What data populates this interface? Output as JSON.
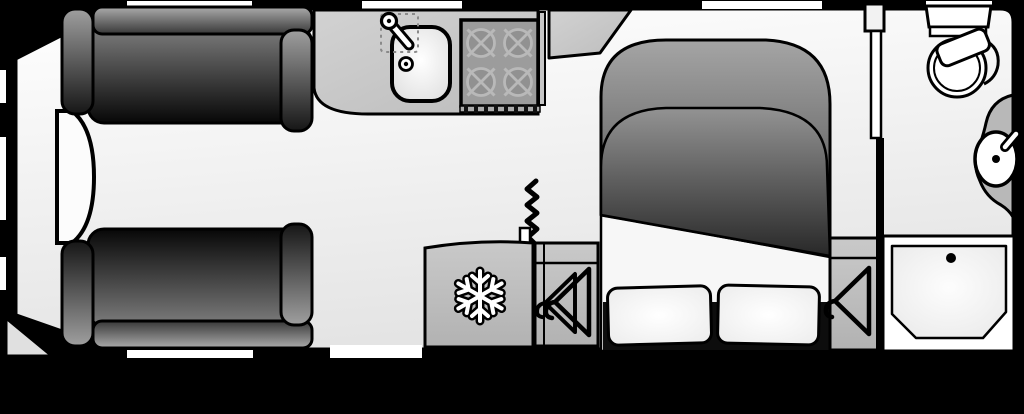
{
  "scene": {
    "type": "caravan-floorplan",
    "description": "Top-down floorplan of a touring caravan, hitch end at left, washroom at right rear",
    "visible_text": "none"
  },
  "colors": {
    "outside": "#000000",
    "wall": "#000000",
    "floor_hi": "#ffffff",
    "floor_lo": "#e6e6e6",
    "worktop": "#c6c6c6",
    "hob": "#9c9c9c",
    "burner_ring": "#b9b9b9",
    "unit_gray": "#bdbdbd",
    "basin_counter": "#b8b8b8",
    "upholstery_light": "#9f9f9f",
    "upholstery_dark": "#0a0a0a",
    "fixture_white": "#ffffff",
    "bed_base": "#0d0d0d"
  },
  "rooms": [
    {
      "name": "front-lounge",
      "position": "left / front",
      "fixtures": [
        "parallel-sofa-top",
        "parallel-sofa-bottom",
        "front-chest-table"
      ]
    },
    {
      "name": "kitchen",
      "position": "top middle-left",
      "fixtures": [
        "worktop",
        "sink",
        "tap",
        "drainer",
        "four-burner-hob",
        "vent-strip"
      ]
    },
    {
      "name": "mid-section",
      "position": "bottom middle",
      "fixtures": [
        "entrance-door-zigzag",
        "fridge-snowflake",
        "wardrobe-double-hanger"
      ]
    },
    {
      "name": "bedroom",
      "position": "middle-right",
      "fixtures": [
        "island-bed-duvet",
        "pillow-left",
        "pillow-right",
        "wardrobe-single-hanger"
      ]
    },
    {
      "name": "washroom",
      "position": "right end",
      "fixtures": [
        "toilet",
        "washbasin",
        "tap",
        "shower-tray",
        "partition-wall",
        "washroom-door"
      ]
    }
  ],
  "icons": [
    {
      "name": "snowflake-icon",
      "meaning": "refrigerator"
    },
    {
      "name": "hanger-icon",
      "meaning": "wardrobe"
    },
    {
      "name": "zigzag-icon",
      "meaning": "entrance door / step"
    },
    {
      "name": "burner-icon",
      "meaning": "gas hob ring"
    }
  ],
  "openings": {
    "top_windows": 4,
    "left_windows": 3,
    "bottom_windows": 1,
    "entrance_door_bottom": 1
  }
}
